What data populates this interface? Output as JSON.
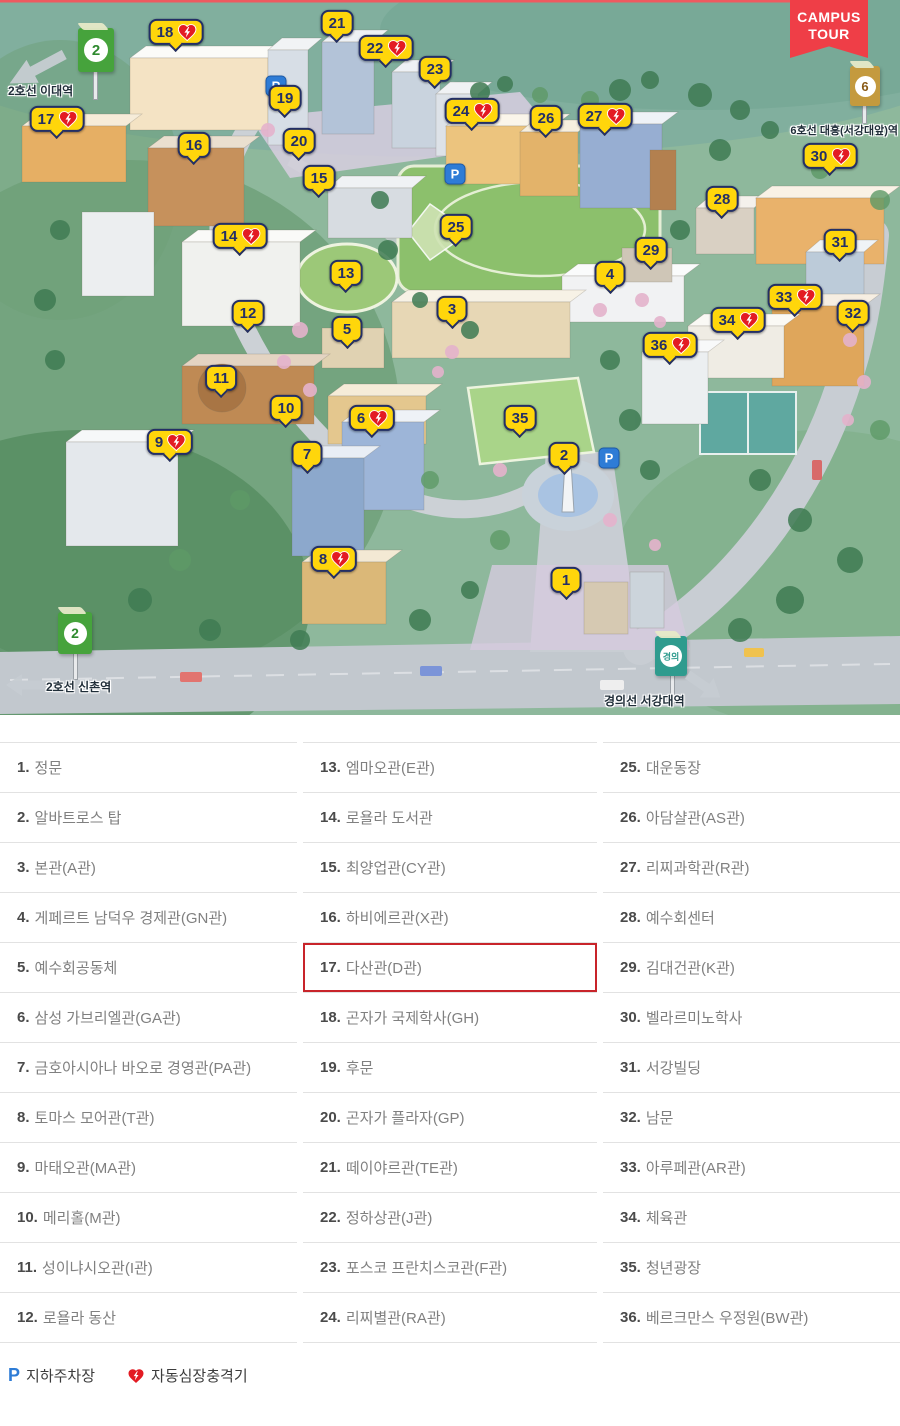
{
  "map": {
    "campus_tour": {
      "line1": "CAMPUS",
      "line2": "TOUR"
    },
    "stations": {
      "edae": {
        "badge": "2",
        "label": "2호선 이대역"
      },
      "sinchon": {
        "badge": "2",
        "label": "2호선 신촌역"
      },
      "daeheung": {
        "badge": "6",
        "label": "6호선 대흥(서강대앞)역"
      },
      "seogang": {
        "badge": "경의",
        "label": "경의선 서강대역"
      }
    },
    "markers": [
      {
        "n": 1,
        "x": 566,
        "y": 582,
        "aed": false
      },
      {
        "n": 2,
        "x": 564,
        "y": 457,
        "aed": false
      },
      {
        "n": 3,
        "x": 452,
        "y": 311,
        "aed": false
      },
      {
        "n": 4,
        "x": 610,
        "y": 276,
        "aed": false
      },
      {
        "n": 5,
        "x": 347,
        "y": 331,
        "aed": false
      },
      {
        "n": 6,
        "x": 372,
        "y": 420,
        "aed": true
      },
      {
        "n": 7,
        "x": 307,
        "y": 456,
        "aed": false
      },
      {
        "n": 8,
        "x": 334,
        "y": 561,
        "aed": true
      },
      {
        "n": 9,
        "x": 170,
        "y": 444,
        "aed": true
      },
      {
        "n": 10,
        "x": 286,
        "y": 410,
        "aed": false
      },
      {
        "n": 11,
        "x": 221,
        "y": 380,
        "aed": false
      },
      {
        "n": 12,
        "x": 248,
        "y": 315,
        "aed": false
      },
      {
        "n": 13,
        "x": 346,
        "y": 275,
        "aed": false
      },
      {
        "n": 14,
        "x": 240,
        "y": 238,
        "aed": true
      },
      {
        "n": 15,
        "x": 319,
        "y": 180,
        "aed": false
      },
      {
        "n": 16,
        "x": 194,
        "y": 147,
        "aed": false
      },
      {
        "n": 17,
        "x": 57,
        "y": 121,
        "aed": true
      },
      {
        "n": 18,
        "x": 176,
        "y": 34,
        "aed": true
      },
      {
        "n": 19,
        "x": 285,
        "y": 100,
        "aed": false
      },
      {
        "n": 20,
        "x": 299,
        "y": 143,
        "aed": false
      },
      {
        "n": 21,
        "x": 337,
        "y": 25,
        "aed": false
      },
      {
        "n": 22,
        "x": 386,
        "y": 50,
        "aed": true
      },
      {
        "n": 23,
        "x": 435,
        "y": 71,
        "aed": false
      },
      {
        "n": 24,
        "x": 472,
        "y": 113,
        "aed": true
      },
      {
        "n": 25,
        "x": 456,
        "y": 229,
        "aed": false
      },
      {
        "n": 26,
        "x": 546,
        "y": 120,
        "aed": false
      },
      {
        "n": 27,
        "x": 605,
        "y": 118,
        "aed": true
      },
      {
        "n": 28,
        "x": 722,
        "y": 201,
        "aed": false
      },
      {
        "n": 29,
        "x": 651,
        "y": 252,
        "aed": false
      },
      {
        "n": 30,
        "x": 830,
        "y": 158,
        "aed": true
      },
      {
        "n": 31,
        "x": 840,
        "y": 244,
        "aed": false
      },
      {
        "n": 32,
        "x": 853,
        "y": 315,
        "aed": false
      },
      {
        "n": 33,
        "x": 795,
        "y": 299,
        "aed": true
      },
      {
        "n": 34,
        "x": 738,
        "y": 322,
        "aed": true
      },
      {
        "n": 35,
        "x": 520,
        "y": 420,
        "aed": false
      },
      {
        "n": 36,
        "x": 670,
        "y": 347,
        "aed": true
      }
    ],
    "parking": [
      {
        "x": 276,
        "y": 86
      },
      {
        "x": 455,
        "y": 174
      },
      {
        "x": 609,
        "y": 458
      }
    ]
  },
  "legend": {
    "highlight_number": 17,
    "items": [
      {
        "n": 1,
        "label": "정문"
      },
      {
        "n": 2,
        "label": "알바트로스 탑"
      },
      {
        "n": 3,
        "label": "본관(A관)"
      },
      {
        "n": 4,
        "label": "게페르트 남덕우 경제관(GN관)"
      },
      {
        "n": 5,
        "label": "예수회공동체"
      },
      {
        "n": 6,
        "label": "삼성 가브리엘관(GA관)"
      },
      {
        "n": 7,
        "label": "금호아시아나 바오로 경영관(PA관)"
      },
      {
        "n": 8,
        "label": "토마스 모어관(T관)"
      },
      {
        "n": 9,
        "label": "마태오관(MA관)"
      },
      {
        "n": 10,
        "label": "메리홀(M관)"
      },
      {
        "n": 11,
        "label": "성이냐시오관(I관)"
      },
      {
        "n": 12,
        "label": "로욜라 동산"
      },
      {
        "n": 13,
        "label": "엠마오관(E관)"
      },
      {
        "n": 14,
        "label": "로욜라 도서관"
      },
      {
        "n": 15,
        "label": "최양업관(CY관)"
      },
      {
        "n": 16,
        "label": "하비에르관(X관)"
      },
      {
        "n": 17,
        "label": "다산관(D관)"
      },
      {
        "n": 18,
        "label": "곤자가 국제학사(GH)"
      },
      {
        "n": 19,
        "label": "후문"
      },
      {
        "n": 20,
        "label": "곤자가 플라자(GP)"
      },
      {
        "n": 21,
        "label": "떼이야르관(TE관)"
      },
      {
        "n": 22,
        "label": "정하상관(J관)"
      },
      {
        "n": 23,
        "label": "포스코 프란치스코관(F관)"
      },
      {
        "n": 24,
        "label": "리찌별관(RA관)"
      },
      {
        "n": 25,
        "label": "대운동장"
      },
      {
        "n": 26,
        "label": "아담샬관(AS관)"
      },
      {
        "n": 27,
        "label": "리찌과학관(R관)"
      },
      {
        "n": 28,
        "label": "예수회센터"
      },
      {
        "n": 29,
        "label": "김대건관(K관)"
      },
      {
        "n": 30,
        "label": "벨라르미노학사"
      },
      {
        "n": 31,
        "label": "서강빌딩"
      },
      {
        "n": 32,
        "label": "남문"
      },
      {
        "n": 33,
        "label": "아루페관(AR관)"
      },
      {
        "n": 34,
        "label": "체육관"
      },
      {
        "n": 35,
        "label": "청년광장"
      },
      {
        "n": 36,
        "label": "베르크만스 우정원(BW관)"
      }
    ]
  },
  "footer": {
    "parking_symbol": "P",
    "parking_label": "지하주차장",
    "aed_label": "자동심장충격기"
  },
  "colors": {
    "marker_yellow": "#ffd60b",
    "marker_navy": "#232f66",
    "aed_red": "#e31b23",
    "highlight_red": "#c8242a",
    "ribbon_red": "#ef3e47",
    "parking_blue": "#2e7cd6",
    "line2_green": "#46a33c",
    "line6_tan": "#c49a3e",
    "gyeongui_teal": "#2f9b8e"
  }
}
